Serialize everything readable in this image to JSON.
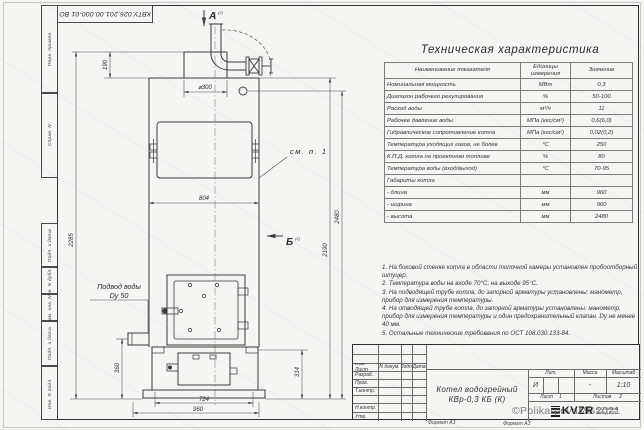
{
  "sheet": {
    "doc_number": "КВТУ.026.201.00.000-01 ВО",
    "format_label": "Формат А3",
    "watermark": "©PolikarpovaMG2021"
  },
  "frame_labels": {
    "perv_primen": "Перв. примен.",
    "sprav_n": "Справ. N",
    "podp_data_1": "Подп. и дата",
    "inv_dubl": "Инв. N дубл.",
    "vzam_inv": "Взам. инв. N",
    "podp_data_2": "Подп. и дата",
    "inv_podl": "Инв. N подл."
  },
  "drawing": {
    "view_a": "А",
    "view_a_ref": "(2)",
    "view_b": "Б",
    "view_b_ref": "(2)",
    "see_note": "см. п. 1",
    "water_line1": "Подвод воды",
    "water_line2": "Dу 50",
    "dims": {
      "chimney": "⌀300",
      "top_height": "190",
      "body_width": "804",
      "left_height": "2285",
      "right_height": "2190",
      "overall_height": "2480",
      "lower_height": "360",
      "ash_height": "314",
      "base_width": "724",
      "overall_width": "960"
    }
  },
  "tech_table": {
    "title": "Техническая характеристика",
    "headers": [
      "Наименование показателя",
      "Единицы измерения",
      "Значение"
    ],
    "rows": [
      [
        "Номинальная мощность",
        "МВт",
        "0,3"
      ],
      [
        "Диапазон рабочего регулирования",
        "%",
        "50-100"
      ],
      [
        "Расход воды",
        "м³/ч",
        "11"
      ],
      [
        "Рабочее давление воды",
        "МПа (кгс/см²)",
        "0,6(6,0)"
      ],
      [
        "Гидравлическое сопротивление котла",
        "МПа (кгс/см²)",
        "0,02(0,2)"
      ],
      [
        "Температура уходящих газов, не более",
        "°С",
        "250"
      ],
      [
        "К.П.Д. котла на проектном топливе",
        "%",
        "80"
      ],
      [
        "Температура воды (вход/выход)",
        "°С",
        "70-95"
      ],
      [
        "Габариты котла",
        "",
        ""
      ],
      [
        "- длина",
        "мм",
        "960"
      ],
      [
        "- ширина",
        "мм",
        "960"
      ],
      [
        "- высота",
        "мм",
        "2480"
      ]
    ]
  },
  "notes": [
    "1. На боковой стенке котла в области топочной камеры установлен пробоотборный штуцер.",
    "2. Температура воды на входе 70°С, на выходе 95°С.",
    "3. На подводящей трубе котла, до запорной арматуры установлены: манометр, прибор для измерения температуры.",
    "4. На отводящей трубе котла, до запорной арматуры установлены: манометр, прибор для измерения температуры и один предохранительный клапан. Dу не менее 40 мм.",
    "5. Остальные технические требования по ОСТ 108.030.133-84."
  ],
  "title_block": {
    "col_izm": "Изм. Лист",
    "col_ndoc": "N докум.",
    "col_podp": "Подп.",
    "col_data": "Дата",
    "row_razrab": "Разраб.",
    "row_prov": "Пров.",
    "row_tkontr": "Т.контр.",
    "row_nkontr": "Н.контр.",
    "row_utv": "Утв.",
    "product_line1": "Котел водогрейный",
    "product_line2": "КВр-0,3 КБ (К)",
    "lit_label": "Лит.",
    "lit_value": "И",
    "massa_label": "Масса",
    "massa_value": "-",
    "masshtab_label": "Масштаб",
    "masshtab_value": "1:10",
    "list_label": "Лист",
    "list_value": "1",
    "listov_label": "Листов",
    "listov_value": "2",
    "logo_text": "KVZR",
    "company_line1": "КОТЕЛЬНЫЙ",
    "company_line2": "ЗАВОД РЭП"
  }
}
